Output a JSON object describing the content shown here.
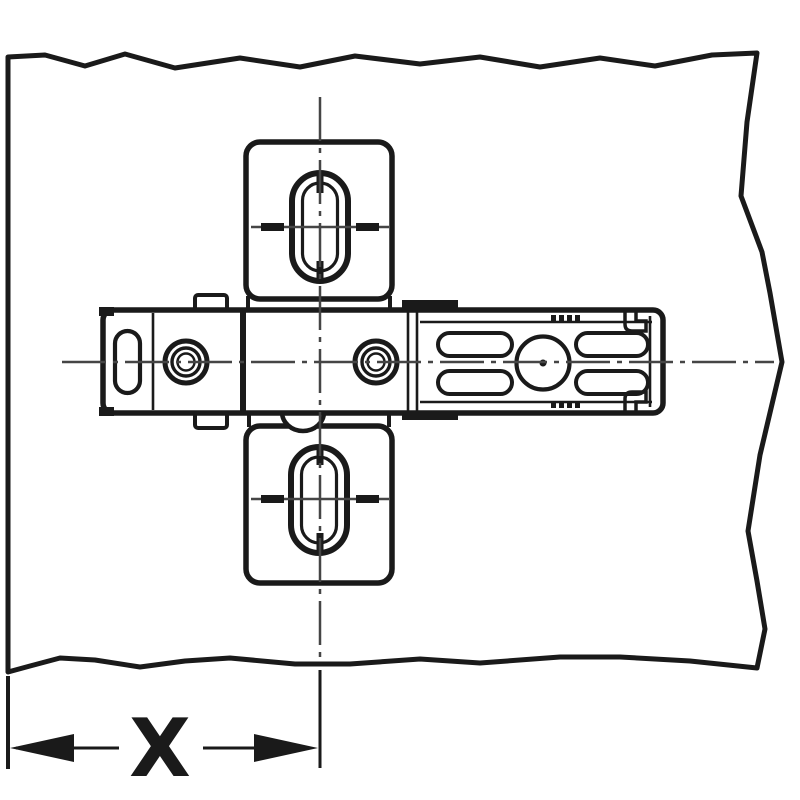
{
  "diagram": {
    "dimension_label": "X",
    "colors": {
      "background": "#ffffff",
      "panel_fill": "#e2e3e5",
      "outline": "#1a1a1a",
      "centerline": "#454545",
      "part_fill": "#ffffff",
      "screw_seat_fill": "#d9dadc",
      "slot_through_fill": "#e2e3e5"
    }
  }
}
